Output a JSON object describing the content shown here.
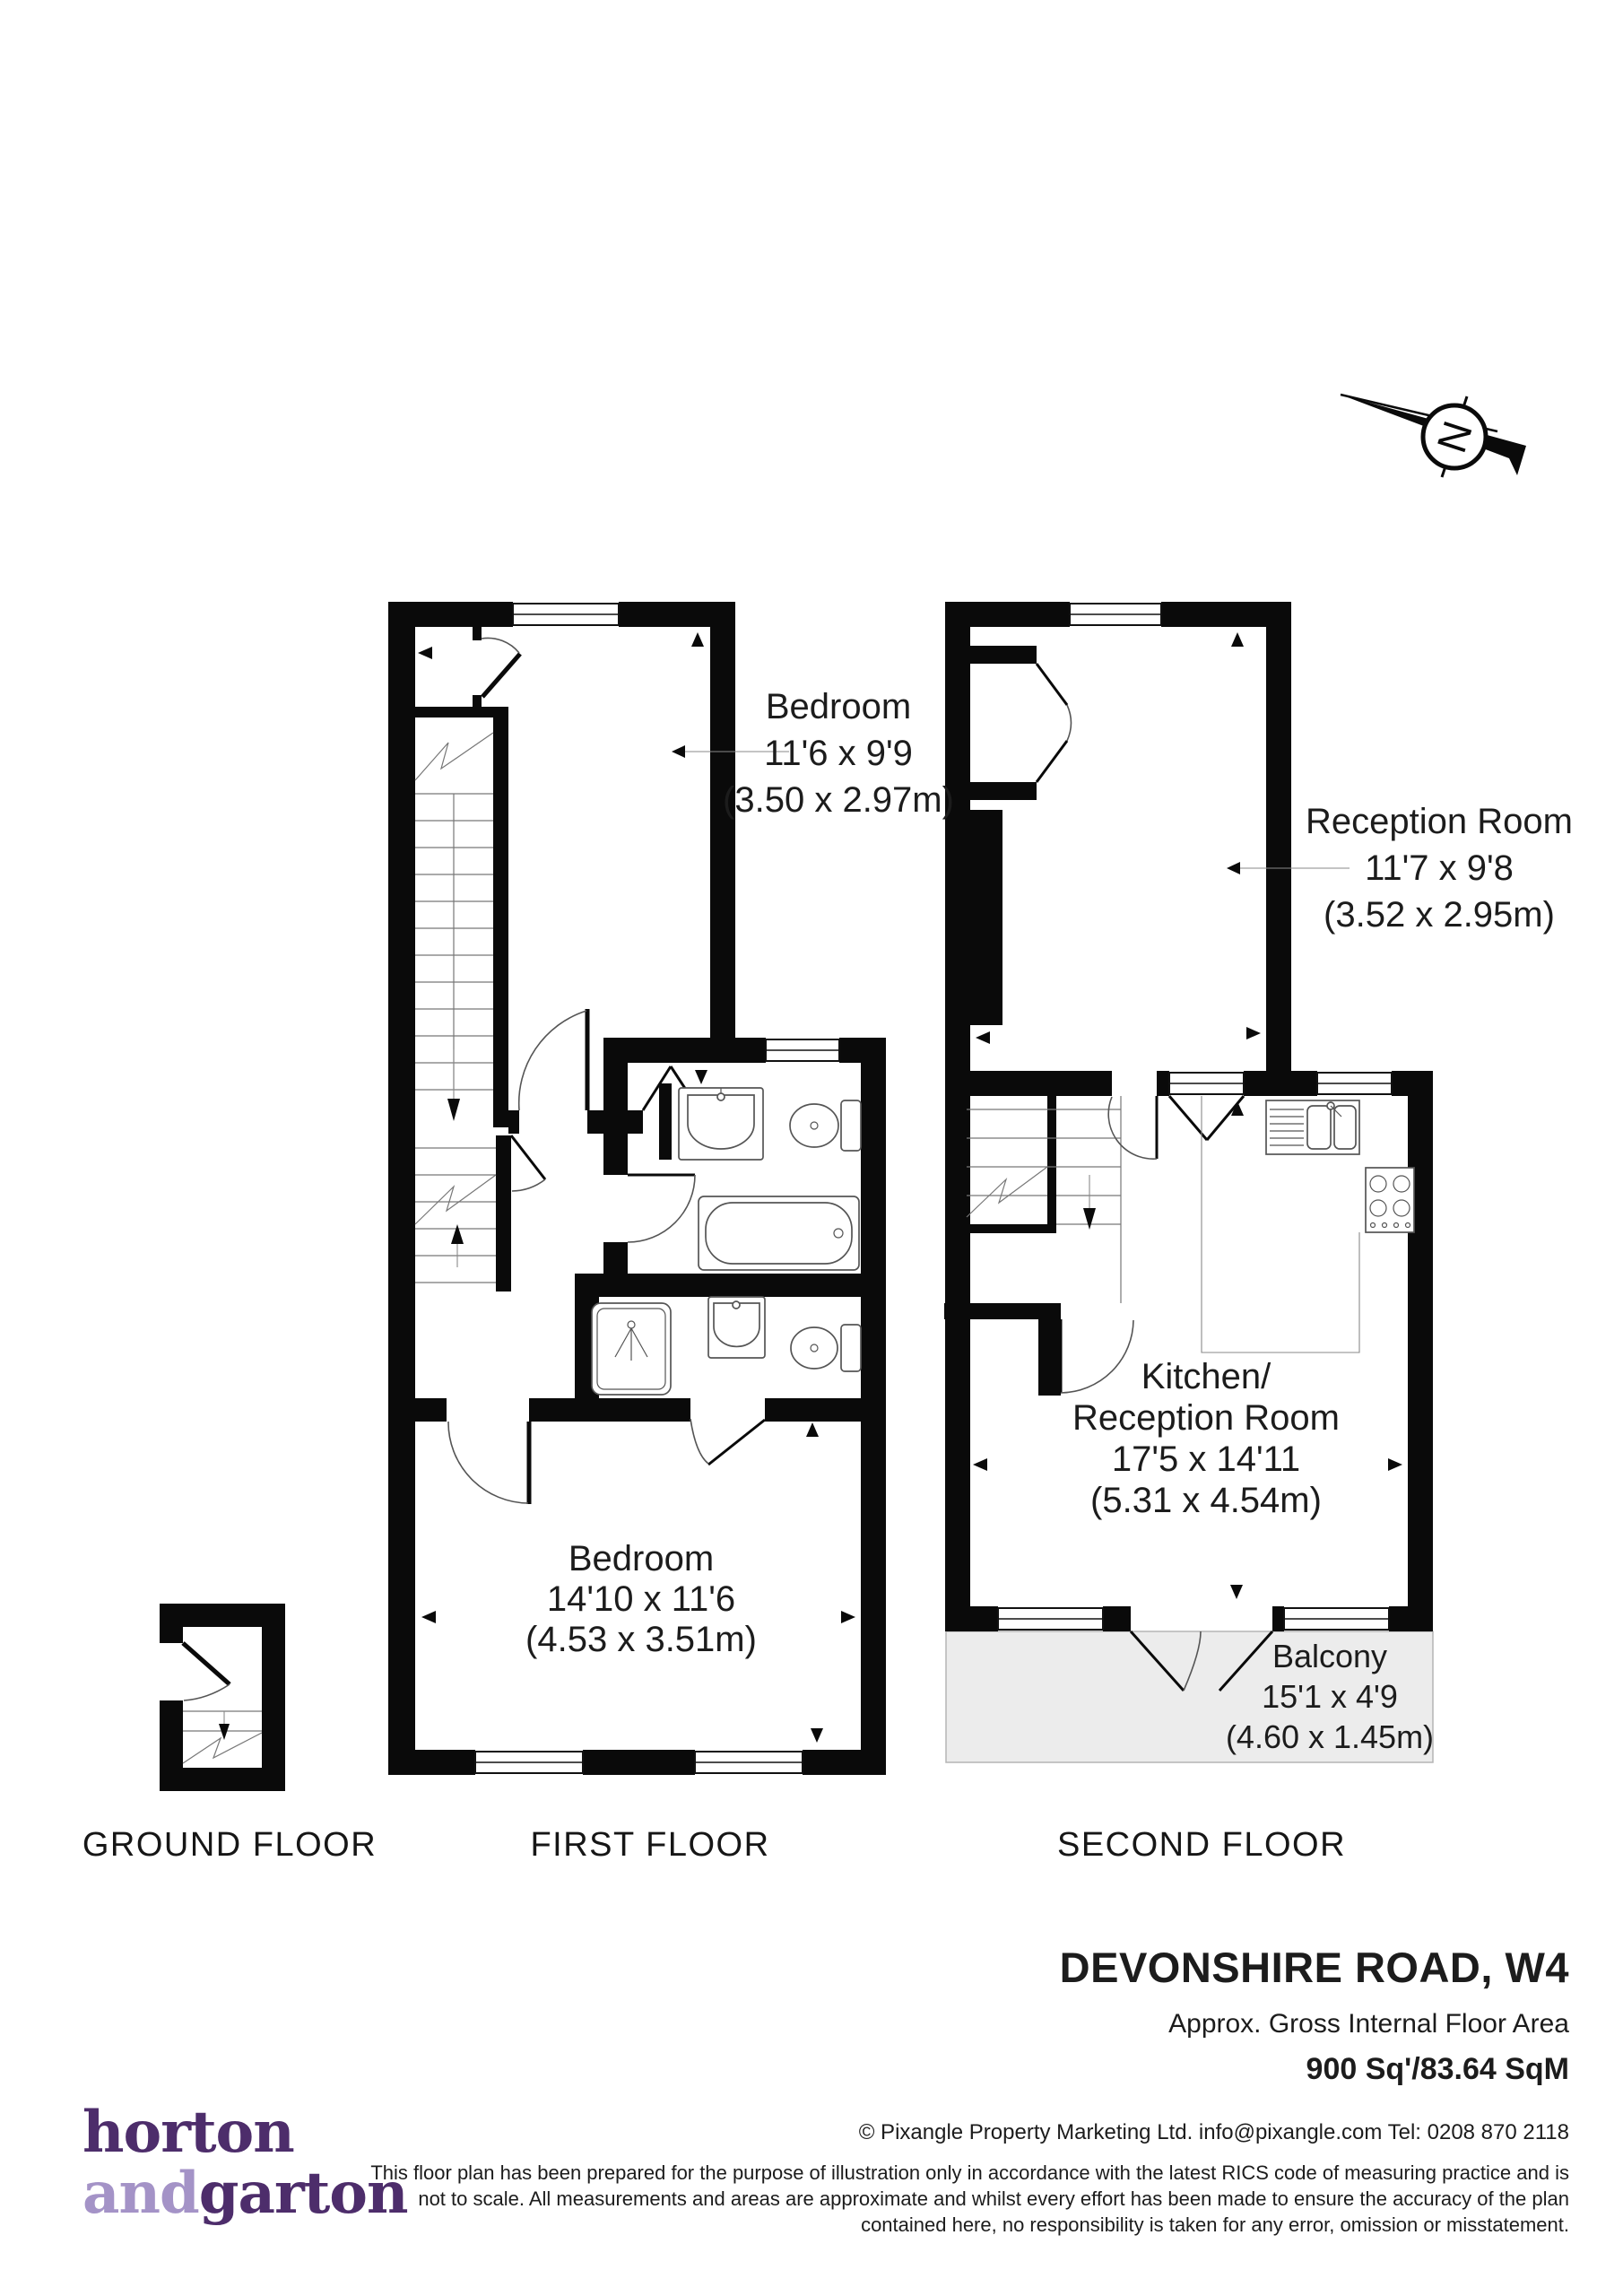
{
  "compass": {
    "letter": "N"
  },
  "rooms": {
    "bedroom1": {
      "name": "Bedroom",
      "size_imperial": "11'6 x 9'9",
      "size_metric": "(3.50 x 2.97m)"
    },
    "reception": {
      "name": "Reception Room",
      "size_imperial": "11'7 x 9'8",
      "size_metric": "(3.52 x 2.95m)"
    },
    "kitchen_reception": {
      "name_line1": "Kitchen/",
      "name_line2": "Reception Room",
      "size_imperial": "17'5 x 14'11",
      "size_metric": "(5.31 x 4.54m)"
    },
    "bedroom2": {
      "name": "Bedroom",
      "size_imperial": "14'10 x 11'6",
      "size_metric": "(4.53 x 3.51m)"
    },
    "balcony": {
      "name": "Balcony",
      "size_imperial": "15'1 x 4'9",
      "size_metric": "(4.60 x 1.45m)"
    }
  },
  "floor_labels": {
    "ground": "GROUND FLOOR",
    "first": "FIRST FLOOR",
    "second": "SECOND FLOOR"
  },
  "title_block": {
    "address": "DEVONSHIRE ROAD, W4",
    "area_label": "Approx. Gross Internal Floor Area",
    "area_value": "900 Sq'/83.64 SqM"
  },
  "footer": {
    "copyright": "© Pixangle Property Marketing Ltd. info@pixangle.com Tel: 0208 870 2118",
    "disclaimer": [
      "This floor plan has been prepared for the purpose of illustration only in accordance with the latest RICS code of measuring practice and is",
      "not to scale. All measurements and areas are approximate and whilst every effort has been made to ensure the accuracy of the plan",
      "contained here, no responsibility is taken for any error, omission or misstatement."
    ]
  },
  "logo": {
    "word1": "horton",
    "word2": "and",
    "word3": "garton",
    "color_dark": "#4d2d6b",
    "color_light": "#a493c7"
  }
}
